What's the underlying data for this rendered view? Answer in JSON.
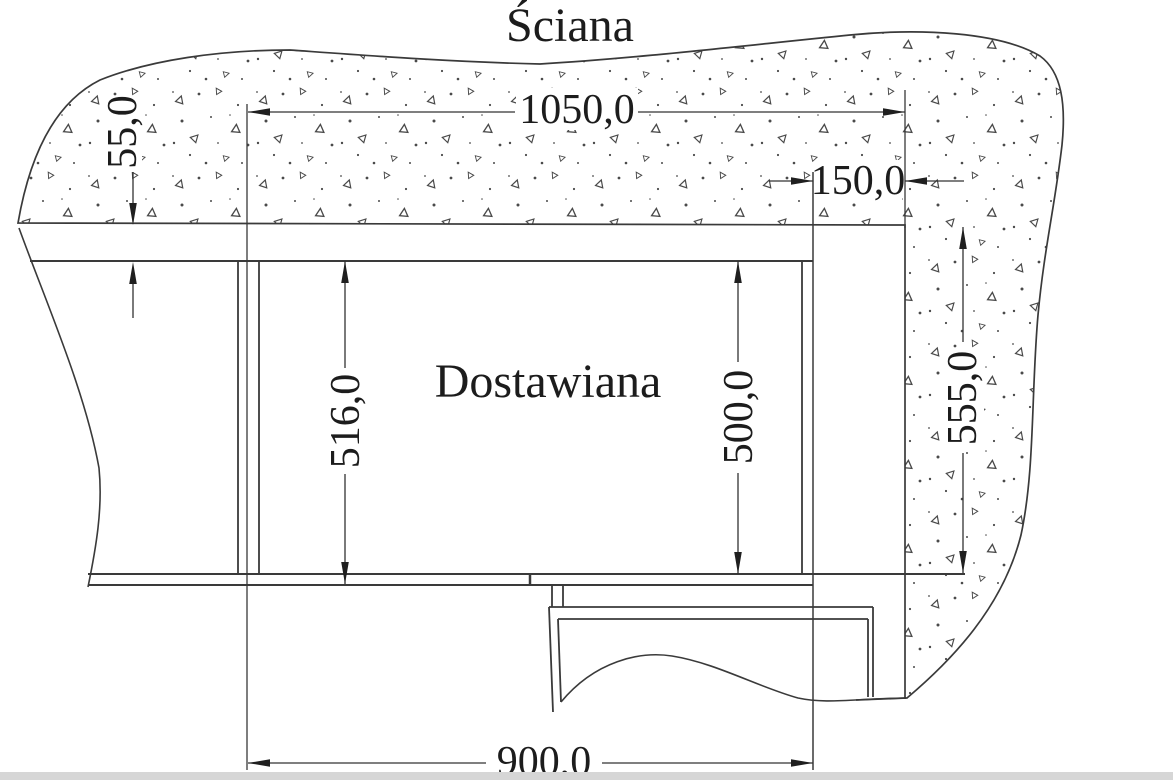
{
  "title": "Ściana",
  "area_label": "Dostawiana",
  "dimensions": {
    "opening_width_total": "1050,0",
    "wall_side_offset": "150,0",
    "top_gap": "55,0",
    "inner_height_left": "516,0",
    "inner_height_right": "500,0",
    "wall_height_right": "555,0",
    "opening_width_bottom": "900,0"
  },
  "colors": {
    "background": "#ffffff",
    "line": "#3a3a3a",
    "text": "#1c1c1c",
    "concrete_marks": "#4a4a4a",
    "bottom_edge_strip": "#d6d6d6"
  }
}
